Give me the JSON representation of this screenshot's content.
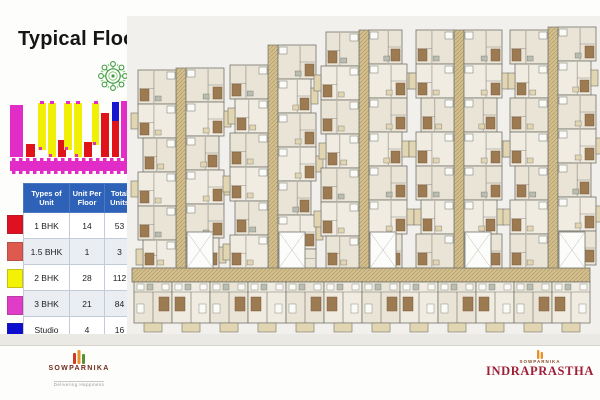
{
  "slide": {
    "title": "Typical Floor Plan"
  },
  "compass": {
    "color": "#3f9d40",
    "color_light": "#7abf6a"
  },
  "key_plan": {
    "colors": {
      "magenta": "#e12cc8",
      "yellow": "#f2ef06",
      "red": "#e01318",
      "blue": "#1518cf"
    },
    "bars": [
      {
        "x": 1,
        "y": 6,
        "w": 13,
        "h": 52,
        "c": "magenta"
      },
      {
        "x": 17,
        "y": 45,
        "w": 9,
        "h": 13,
        "c": "red"
      },
      {
        "x": 29,
        "y": 4,
        "w": 8,
        "h": 47,
        "c": "yellow"
      },
      {
        "x": 39,
        "y": 4,
        "w": 8,
        "h": 54,
        "c": "yellow"
      },
      {
        "x": 49,
        "y": 41,
        "w": 8,
        "h": 17,
        "c": "red"
      },
      {
        "x": 55,
        "y": 4,
        "w": 8,
        "h": 47,
        "c": "yellow"
      },
      {
        "x": 65,
        "y": 4,
        "w": 8,
        "h": 54,
        "c": "yellow"
      },
      {
        "x": 75,
        "y": 43,
        "w": 8,
        "h": 15,
        "c": "red"
      },
      {
        "x": 83,
        "y": 4,
        "w": 7,
        "h": 42,
        "c": "yellow"
      },
      {
        "x": 92,
        "y": 14,
        "w": 8,
        "h": 44,
        "c": "red"
      },
      {
        "x": 103,
        "y": 3,
        "w": 7,
        "h": 19,
        "c": "blue"
      },
      {
        "x": 103,
        "y": 22,
        "w": 7,
        "h": 36,
        "c": "red"
      },
      {
        "x": 112,
        "y": 2,
        "w": 13,
        "h": 57,
        "c": "magenta"
      }
    ],
    "base_strip": {
      "x": 1,
      "y": 62,
      "w": 124,
      "h": 10
    }
  },
  "unit_table": {
    "header_bg": "#2e62b8",
    "headers": [
      "Types of Unit",
      "Unit Per Floor",
      "Total Units"
    ],
    "rows": [
      {
        "swatch": "#e01020",
        "type": "1 BHK",
        "per_floor": "14",
        "total": "53"
      },
      {
        "swatch": "#df5a4e",
        "type": "1.5 BHK",
        "per_floor": "1",
        "total": "3"
      },
      {
        "swatch": "#f2f202",
        "type": "2 BHK",
        "per_floor": "28",
        "total": "112"
      },
      {
        "swatch": "#e03cc8",
        "type": "3 BHK",
        "per_floor": "21",
        "total": "84"
      },
      {
        "swatch": "#0d0dd0",
        "type": "Studio",
        "per_floor": "4",
        "total": "16"
      }
    ]
  },
  "floor_plan": {
    "colors": {
      "backdrop": "#f2f0ec",
      "corridor": "#d3c08f",
      "corridor_hatch": "#b89e6c",
      "unit_a": "#f1ece2",
      "unit_b": "#eae4d7",
      "wall": "#73736b",
      "brown": "#9c7a52",
      "brown_dark": "#7e5d3c",
      "tan_light": "#e2d5b2",
      "white_room": "#fafaf7",
      "sage": "#b7bdb0",
      "amenity": "#fcfcfb"
    },
    "corridor_band": {
      "x": 5,
      "y": 252,
      "w": 458,
      "h": 14
    },
    "wings": [
      {
        "corridor_x": 49,
        "top": 52,
        "left_top": 54
      },
      {
        "corridor_x": 141,
        "top": 29,
        "left_top": 49
      },
      {
        "corridor_x": 232,
        "top": 14,
        "left_top": 16
      },
      {
        "corridor_x": 327,
        "top": 14,
        "left_top": 14
      },
      {
        "corridor_x": 421,
        "top": 11,
        "left_top": 14
      }
    ],
    "bottom_units": 12
  },
  "footer": {
    "left": {
      "brand": "SOWPARNIKA",
      "tagline": "Delivering Happiness",
      "mark_colors": [
        "#cf3a23",
        "#e8902a",
        "#56922e"
      ]
    },
    "right": {
      "brand_small": "SOWPARNIKA",
      "project": "INDRAPRASTHA",
      "mark_color": "#e8902a"
    }
  }
}
